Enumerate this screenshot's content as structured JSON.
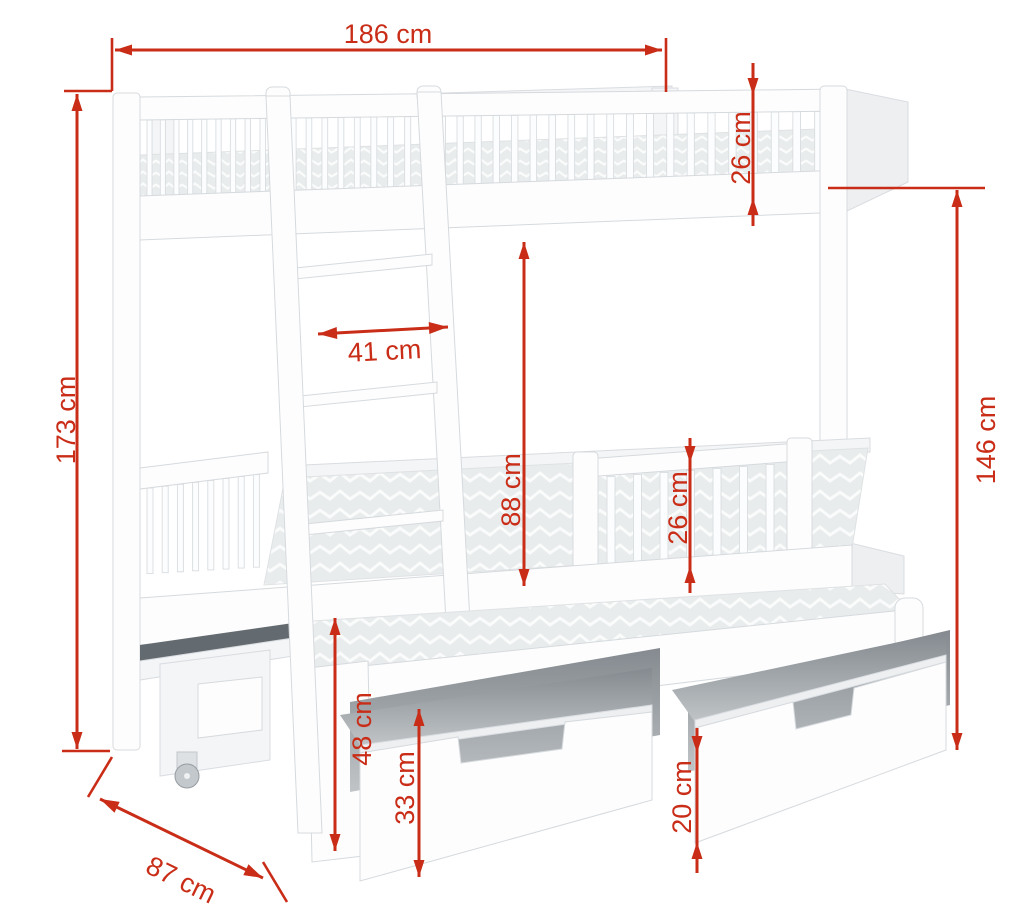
{
  "diagram": {
    "subject": "bunk bed with trundle bed and two storage drawers",
    "unit": "cm",
    "dimensions": [
      {
        "id": "total-length",
        "label": "186 cm",
        "value": 186,
        "unit": "cm",
        "orientation": "horizontal"
      },
      {
        "id": "upper-guardrail",
        "label": "26 cm",
        "value": 26,
        "unit": "cm",
        "orientation": "vertical"
      },
      {
        "id": "total-height",
        "label": "173 cm",
        "value": 173,
        "unit": "cm",
        "orientation": "vertical"
      },
      {
        "id": "ladder-width",
        "label": "41 cm",
        "value": 41,
        "unit": "cm",
        "orientation": "horizontal"
      },
      {
        "id": "bunk-clearance",
        "label": "88 cm",
        "value": 88,
        "unit": "cm",
        "orientation": "vertical"
      },
      {
        "id": "lower-guardrail",
        "label": "26 cm",
        "value": 26,
        "unit": "cm",
        "orientation": "vertical"
      },
      {
        "id": "right-side-height",
        "label": "146 cm",
        "value": 146,
        "unit": "cm",
        "orientation": "vertical"
      },
      {
        "id": "trundle-height",
        "label": "48 cm",
        "value": 48,
        "unit": "cm",
        "orientation": "vertical"
      },
      {
        "id": "drawer-height",
        "label": "33 cm",
        "value": 33,
        "unit": "cm",
        "orientation": "vertical"
      },
      {
        "id": "drawer-opening",
        "label": "20 cm",
        "value": 20,
        "unit": "cm",
        "orientation": "vertical"
      },
      {
        "id": "depth",
        "label": "87 cm",
        "value": 87,
        "unit": "cm",
        "orientation": "diagonal"
      }
    ],
    "colors": {
      "dimension_red": "#c92d17",
      "bed_white": "#fdfdfe",
      "outline_gray": "#d6dadd",
      "background": "#ffffff"
    }
  }
}
